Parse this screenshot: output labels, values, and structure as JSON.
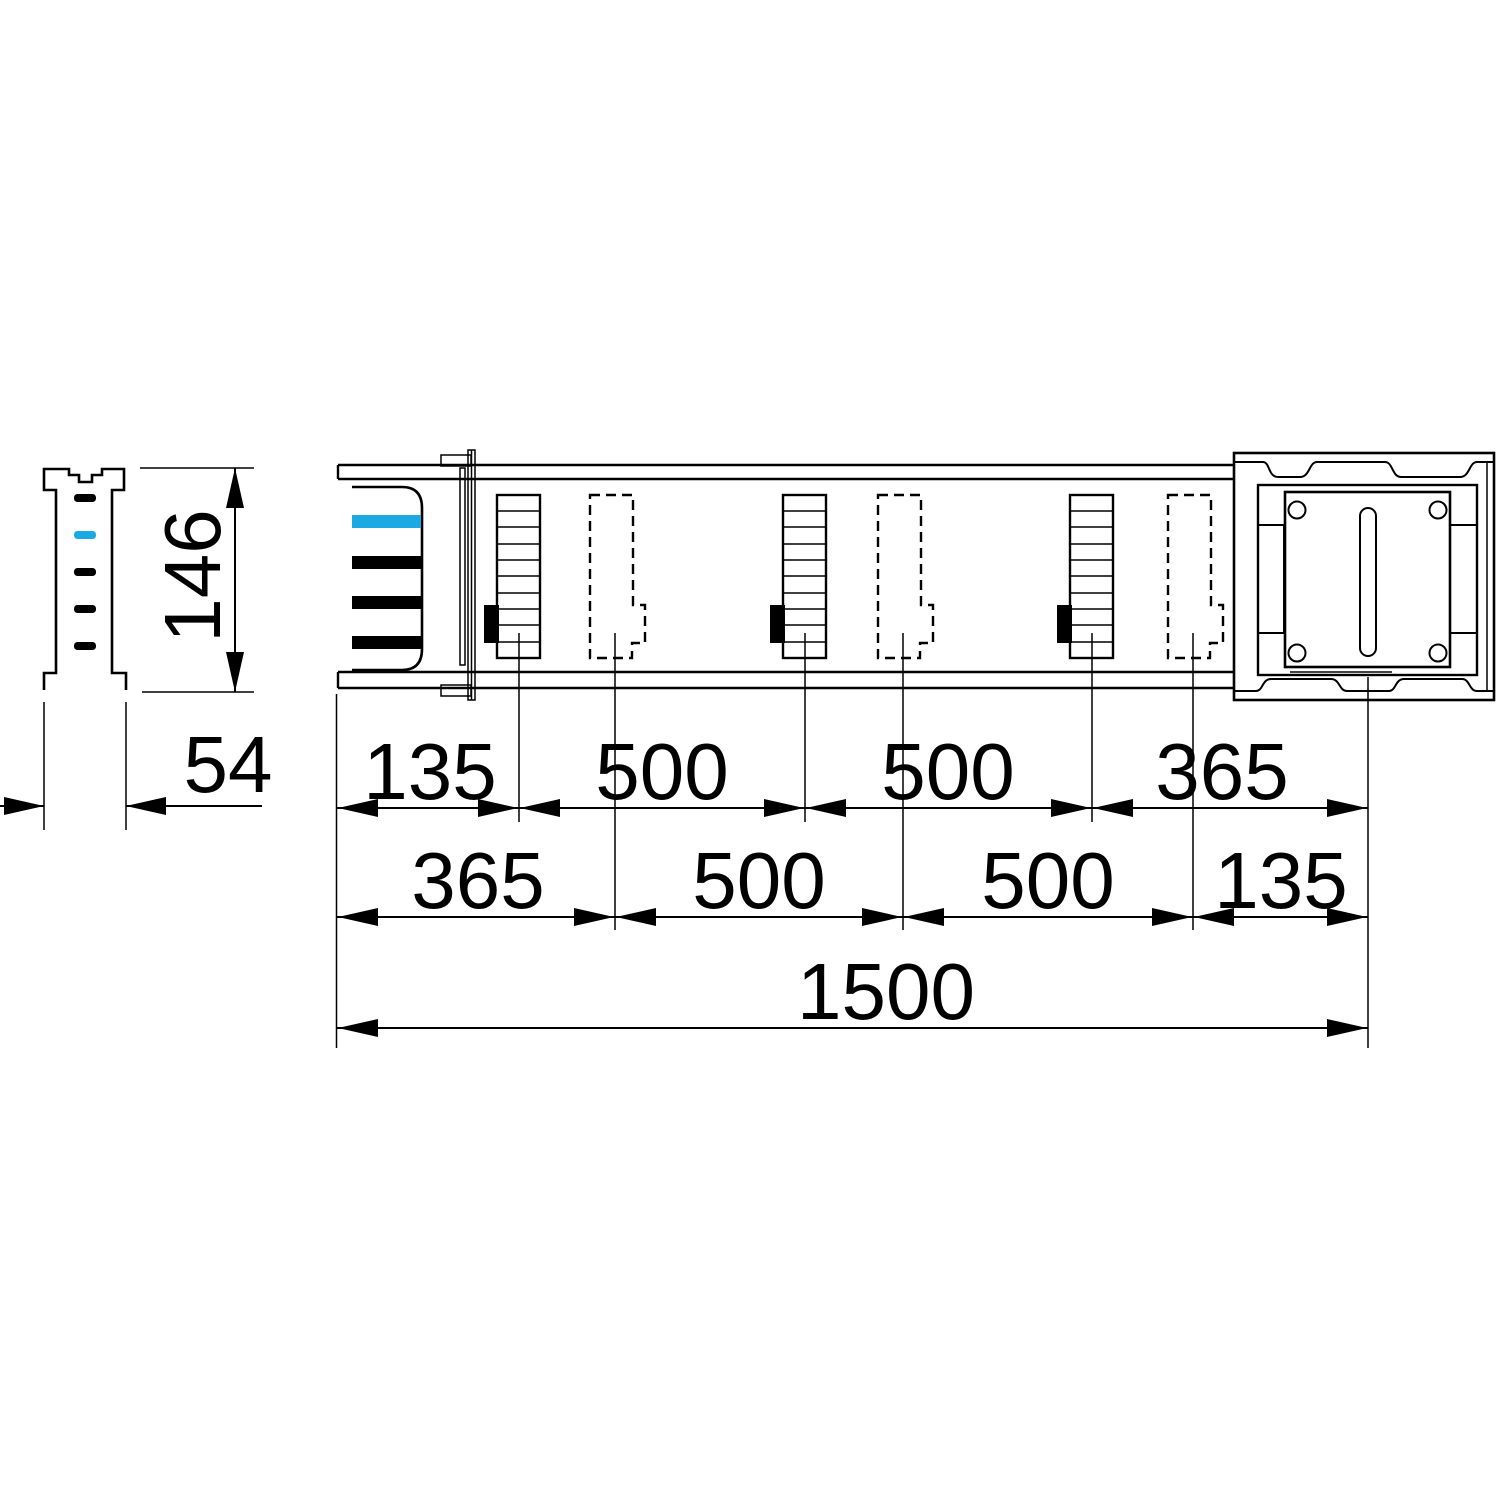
{
  "drawing": {
    "type": "busbar-trunking-dimension-drawing",
    "colors": {
      "line": "#000000",
      "background": "#ffffff",
      "accent": "#1BA9E4"
    },
    "side_view": {
      "height_label": "146",
      "width_label": "54",
      "conductor_tick_count": 5,
      "accent_tick_position": 2
    },
    "main_view": {
      "solid_outlet_count": 3,
      "dashed_outlet_count": 3,
      "bolt_hole_count": 4,
      "dim_row_top": [
        "135",
        "500",
        "500",
        "365"
      ],
      "dim_row_middle": [
        "365",
        "500",
        "500",
        "135"
      ],
      "dim_total": "1500"
    }
  }
}
